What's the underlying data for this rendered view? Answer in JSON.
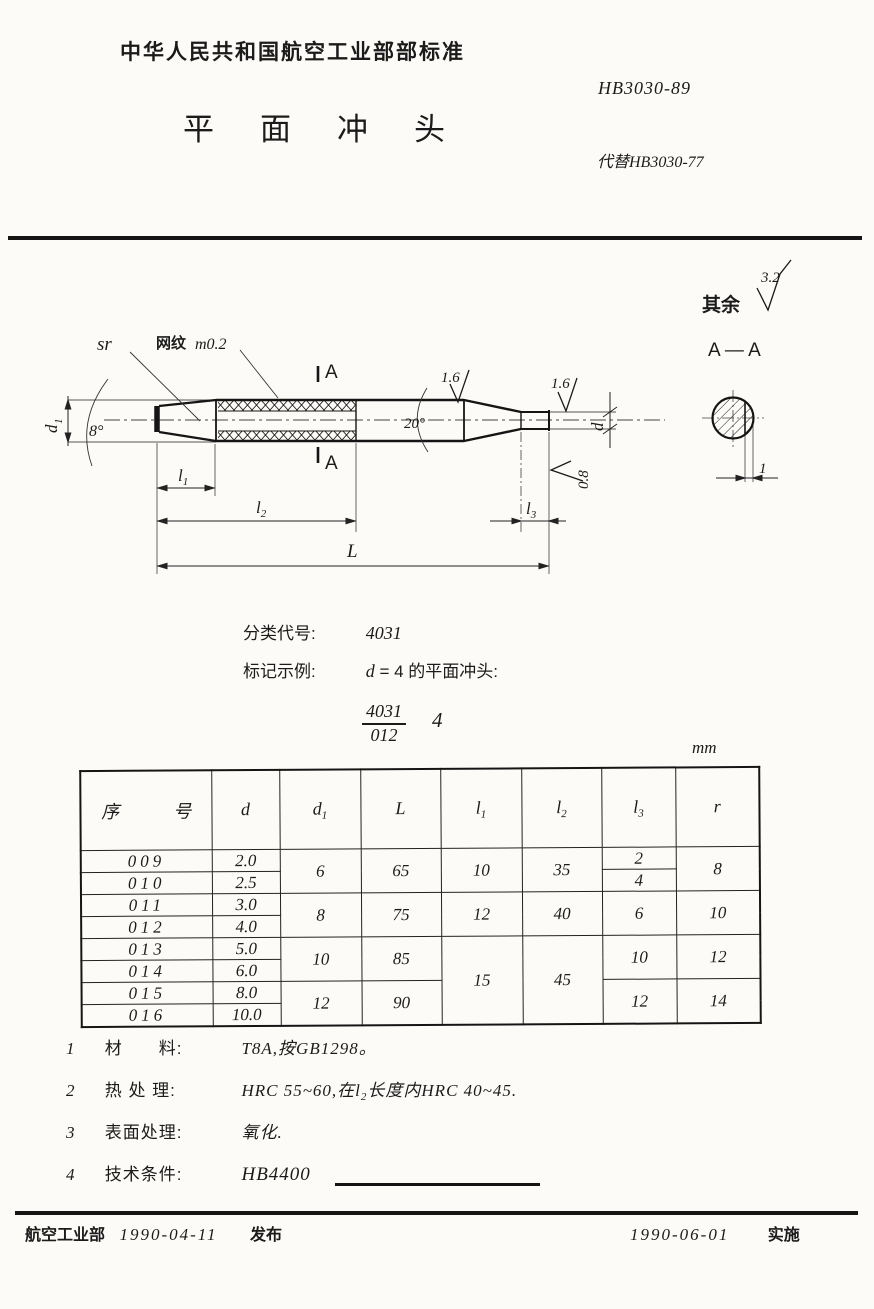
{
  "colors": {
    "paper": "#fcfbf8",
    "ink": "#1b1b1b"
  },
  "header": {
    "ministry_title": "中华人民共和国航空工业部部标准",
    "standard_number": "HB3030-89",
    "document_title": "平面冲头",
    "replaces": "代替HB3030-77"
  },
  "classification": {
    "label": "分类代号:",
    "value": "4031"
  },
  "marking": {
    "label": "标记示例:",
    "variable": "d",
    "rest": "= 4 的平面冲头:",
    "example_numerator": "4031",
    "example_denominator": "012",
    "example_suffix": "4"
  },
  "unit_label": "mm",
  "drawing": {
    "sr_label": "sr",
    "knurl_cjk": "网纹",
    "knurl_val": "m0.2",
    "angle_left": "8°",
    "angle_right": "20°",
    "rough_taper": "1.6",
    "rough_tip": "1.6",
    "rough_face": "0.8",
    "rough_rest_prefix": "其余",
    "rough_rest_value": "3.2",
    "section_mark_top": "A",
    "section_mark_bottom": "A",
    "section_title": "A — A",
    "dim_d1_base": "d",
    "dim_d1_sub": "1",
    "dim_d_base": "d",
    "dim_l1_base": "l",
    "dim_l1_sub": "1",
    "dim_l2_base": "l",
    "dim_l2_sub": "2",
    "dim_l3_base": "l",
    "dim_l3_sub": "3",
    "dim_L": "L",
    "chord_dim": "1"
  },
  "table": {
    "headers": [
      {
        "t": "序　号",
        "sub": ""
      },
      {
        "t": "d",
        "sub": ""
      },
      {
        "t": "d",
        "sub": "1"
      },
      {
        "t": "L",
        "sub": ""
      },
      {
        "t": "l",
        "sub": "1"
      },
      {
        "t": "l",
        "sub": "2"
      },
      {
        "t": "l",
        "sub": "3"
      },
      {
        "t": "r",
        "sub": ""
      }
    ],
    "rows": [
      {
        "no": "009",
        "d": "2.0"
      },
      {
        "no": "010",
        "d": "2.5"
      },
      {
        "no": "011",
        "d": "3.0"
      },
      {
        "no": "012",
        "d": "4.0"
      },
      {
        "no": "013",
        "d": "5.0"
      },
      {
        "no": "014",
        "d": "6.0"
      },
      {
        "no": "015",
        "d": "8.0"
      },
      {
        "no": "016",
        "d": "10.0"
      }
    ],
    "merged": {
      "d1": [
        "6",
        "8",
        "10",
        "12"
      ],
      "L": [
        "65",
        "75",
        "85",
        "90"
      ],
      "l1": [
        "10",
        "12",
        "15"
      ],
      "l2": [
        "35",
        "40",
        "45"
      ],
      "l3": [
        "2",
        "4",
        "6",
        "10",
        "12"
      ],
      "r": [
        "8",
        "10",
        "12",
        "14"
      ]
    }
  },
  "notes": [
    {
      "no": "1",
      "label": "材　　料:",
      "text": "T8A,按GB1298。"
    },
    {
      "no": "2",
      "label": "热 处 理:",
      "pre": "HRC 55~60,在",
      "var": "l",
      "sub": "2",
      "post": "长度内HRC 40~45."
    },
    {
      "no": "3",
      "label": "表面处理:",
      "text": "氧化."
    },
    {
      "no": "4",
      "label": "技术条件:",
      "text": "HB4400"
    }
  ],
  "footer": {
    "issuer": "航空工业部",
    "issue_date": "1990-04-11",
    "issue_action": "发布",
    "effective_date": "1990-06-01",
    "effective_action": "实施"
  }
}
